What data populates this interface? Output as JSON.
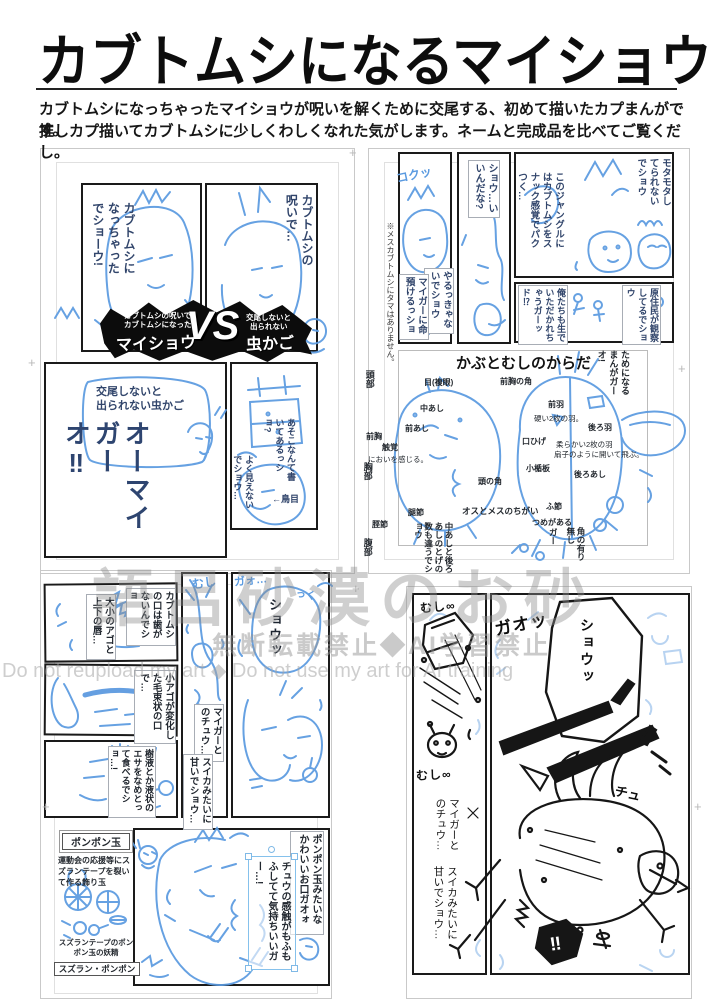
{
  "header": {
    "title": "カブトムシになるマイショウ",
    "desc_line1": "カブトムシになっちゃったマイショウが呪いを解くために交尾する、初めて描いたカプまんがです。",
    "desc_line2": "推しカプ描いてカブトムシに少しくわしくなれた気がします。ネームと完成品を比べてご覧くだし。"
  },
  "watermark": {
    "line1": "語呂砂漠のお砂",
    "line2": "無断転載禁止◆AI学習禁止",
    "line3": "Do not reupload my art ◆ Do not use my art for AI training"
  },
  "page1": {
    "panel_left_dialogue": "カブトムシになっちゃったでショーウ!",
    "panel_right_dialogue": "カブトムシの呪いで…",
    "vs_banner": {
      "left_sub1": "カブトムシの呪いで",
      "left_sub2": "カブトムシになった",
      "left_name": "マイショウ",
      "vs": "VS",
      "right_sub1": "交尾しないと",
      "right_sub2": "出られない",
      "right_name": "虫かご"
    },
    "cage_caption": "交尾しないと\n出られない虫かご",
    "cage_shout": "オーマイガーオ‼",
    "sign_dialogue": "あそこなんて書いてあるっショ?",
    "sign_note": "←鳥目",
    "sign_dialogue2": "よく見えないでショウ…"
  },
  "page2": {
    "jungle_dialogue1": "モタモタしてられないでショウ",
    "jungle_dialogue2": "このジャングルにはカブトムシをスナック感覚でパクつく…",
    "natives_dialogue1": "原住民が観察してるでショウ",
    "natives_dialogue2": "俺たちも生でいただかれちゃうガーッド⁉",
    "confirm_dialogue": "ショウ…いいんだな?",
    "resolve_dialogue1": "やるっきゃないでショウ",
    "resolve_dialogue2": "マイガーに命預けるっショ",
    "resolve_sfx": "コクッ",
    "footnote": "※メスカブトムシにタマはありません。"
  },
  "diagram": {
    "title": "かぶとむしのからだ",
    "side_note": "ためになるまんがガーオ!",
    "part_head": "頭部",
    "part_prothorax": "前胸",
    "part_thorax": "胸部",
    "part_abdomen": "腹部",
    "label_eye": "目(複眼)",
    "label_midleg": "中あし",
    "label_foreleg": "前あし",
    "label_antenna": "触覚",
    "label_antenna_note": "においを感じる。",
    "label_headhorn": "頭の角",
    "label_femur": "腿節",
    "label_tibia": "脛節",
    "label_diff_title": "オスとメスのちがい",
    "label_diff_note": "中あしと後ろあしのとげの数も違うでショウ",
    "label_pronotum_horn": "前胸の角",
    "label_forewing": "前羽",
    "label_forewing_note": "硬い2枚の羽。",
    "label_hindwing": "後ろ羽",
    "label_hindwing_note1": "柔らかい2枚の羽",
    "label_hindwing_note2": "扇子のように開いて飛ぶ。",
    "label_mouth": "口ひげ",
    "label_scutellum": "小楯板",
    "label_hindleg": "後ろあし",
    "label_tarsus": "ふ節",
    "label_claw": "つめがある",
    "label_horn_diff": "角の有り無し",
    "label_horn_diff2": "ガー"
  },
  "page3": {
    "mouth_dialogue1": "カブトムシの口は歯がないんでショ",
    "mouth_dialogue2": "大小のアゴと上下の唇…",
    "jaw_dialogue": "小アゴが変化した毛束状の口で…",
    "food_dialogue": "樹液とか液状のエサをなめとって食べるでショ…!",
    "kiss_dialogue1": "マイガーとのチュウ…",
    "kiss_dialogue2": "スイカみたいに甘いでショウ…",
    "shout": "ショウッ",
    "sfx_mushi": "むし",
    "sfx_gao": "ガォ…",
    "sfx_kuku": "っく",
    "pompom": {
      "box_title": "ポンポン玉",
      "description": "運動会の応援等にスズランテープを裂いて作る飾り玉",
      "caption": "スズランテープのポンポン玉の妖精",
      "name": "スズラン・ポンポン"
    },
    "mouth_praise": "ポンポン玉みたいなかわいいお口ガオォ",
    "selected_text": "チュウの感触がもふもふしてて気持ちいいガー…!"
  },
  "page4": {
    "sfx_mushi1": "むし∞",
    "sfx_gao": "ガオッ",
    "bubble_shout": "ショウッ",
    "sfx_chu": "チュ",
    "sfx_mushi2": "むし∞",
    "kiss_dialogue1": "マイガーとのチュウ…",
    "kiss_dialogue2": "スイカみたいに甘いでショウ…",
    "burst": "‼"
  }
}
